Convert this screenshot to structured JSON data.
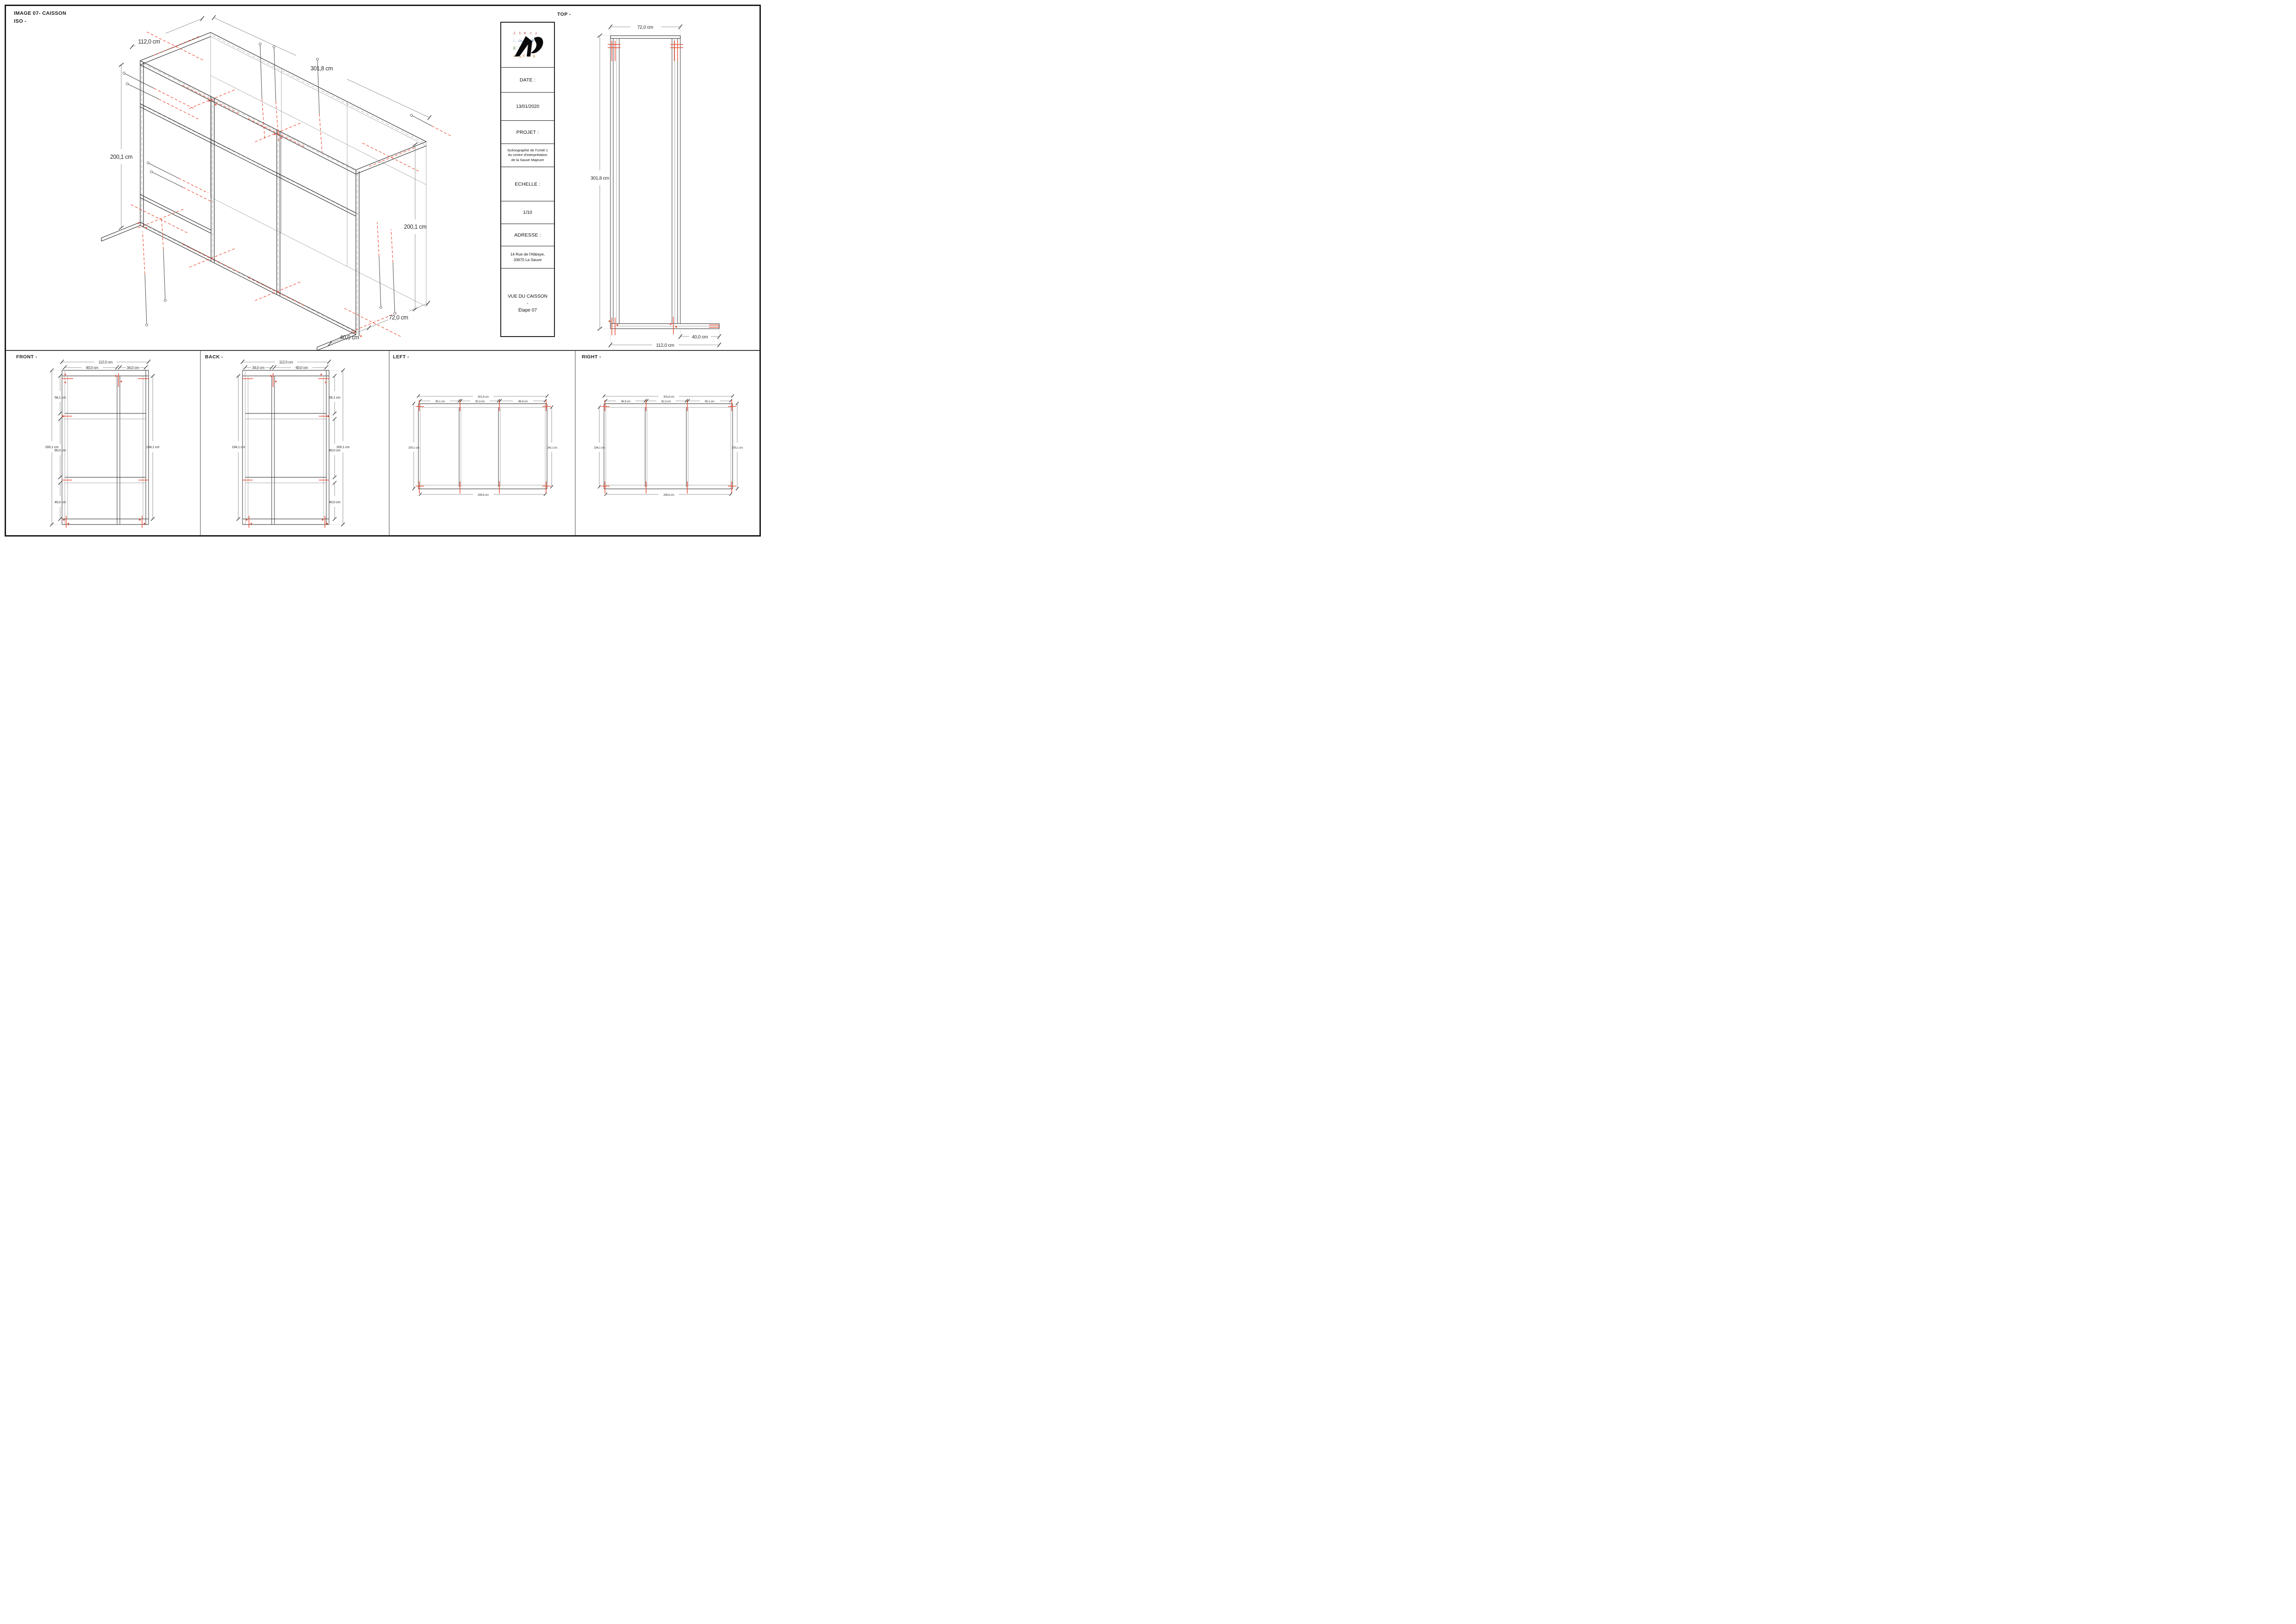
{
  "page": {
    "header_line1": "IMAGE 07- CAISSON",
    "header_line2": "ISO -"
  },
  "views": {
    "top_label": "TOP -",
    "front_label": "FRONT -",
    "back_label": "BACK -",
    "left_label": "LEFT -",
    "right_label": "RIGHT -"
  },
  "title_block": {
    "date_label": "DATE :",
    "date_value": "13/01/2020",
    "project_label": "PROJET :",
    "project_line1": "Scénographie de l'Unité 1",
    "project_line2": "du centre d'interprétation",
    "project_line3": "de la Sauve Majeure",
    "scale_label": "ECHELLE :",
    "scale_value": "1/10",
    "address_label": "ADRESSE :",
    "address_line1": "14 Rue de l'Abbaye,",
    "address_line2": "33670 La Sauve",
    "view_title": "VUE DU CAISSON",
    "view_sep": "-",
    "view_step": "Étape 07"
  },
  "logo": {
    "row1": "人 Σ Ҝ イ y",
    "row2": "ஃ ௸ U #",
    "row3": "辵 क ♡",
    "row4": "キ ق Ⴟ ৬ ⵣ"
  },
  "dims": {
    "iso": {
      "width": "112,0 cm",
      "length": "301,8 cm",
      "height_left": "200,1 cm",
      "height_right": "200,1 cm",
      "depth": "72,0 cm",
      "foot": "40,0 cm"
    },
    "top": {
      "width": "72,0 cm",
      "length": "301,8 cm",
      "foot": "40,0 cm",
      "total_width": "112,0 cm"
    },
    "front": {
      "total_width": "112,0 cm",
      "bay_left": "60,0 cm",
      "bay_right": "34,0 cm",
      "seg_top": "56,1 cm",
      "height": "200,1 cm",
      "seg_mid": "80,0 cm",
      "seg_bottom": "40,0 cm",
      "inner_height": "194,1 cm"
    },
    "back": {
      "total_width": "112,0 cm",
      "bay_left": "34,0 cm",
      "bay_right": "60,0 cm",
      "inner_height": "194,1 cm",
      "seg_top": "56,1 cm",
      "height": "200,1 cm",
      "seg_mid": "80,0 cm",
      "seg_bottom": "40,0 cm"
    },
    "left": {
      "length": "301,8 cm",
      "seg1": "95,1 cm",
      "seg2": "92,3 cm",
      "seg3": "96,9 cm",
      "height_left": "200,1 cm",
      "inner_height": "194,1 cm",
      "bottom_length": "295,8 cm"
    },
    "right": {
      "length": "301,8 cm",
      "seg1": "96,9 cm",
      "seg2": "92,3 cm",
      "seg3": "95,1 cm",
      "inner_height": "194,1 cm",
      "height_right": "200,1 cm",
      "bottom_length": "295,8 cm"
    }
  },
  "colors": {
    "accent_red": "#e8391f",
    "line_black": "#222222",
    "dim_gray": "#7a7a7a"
  }
}
